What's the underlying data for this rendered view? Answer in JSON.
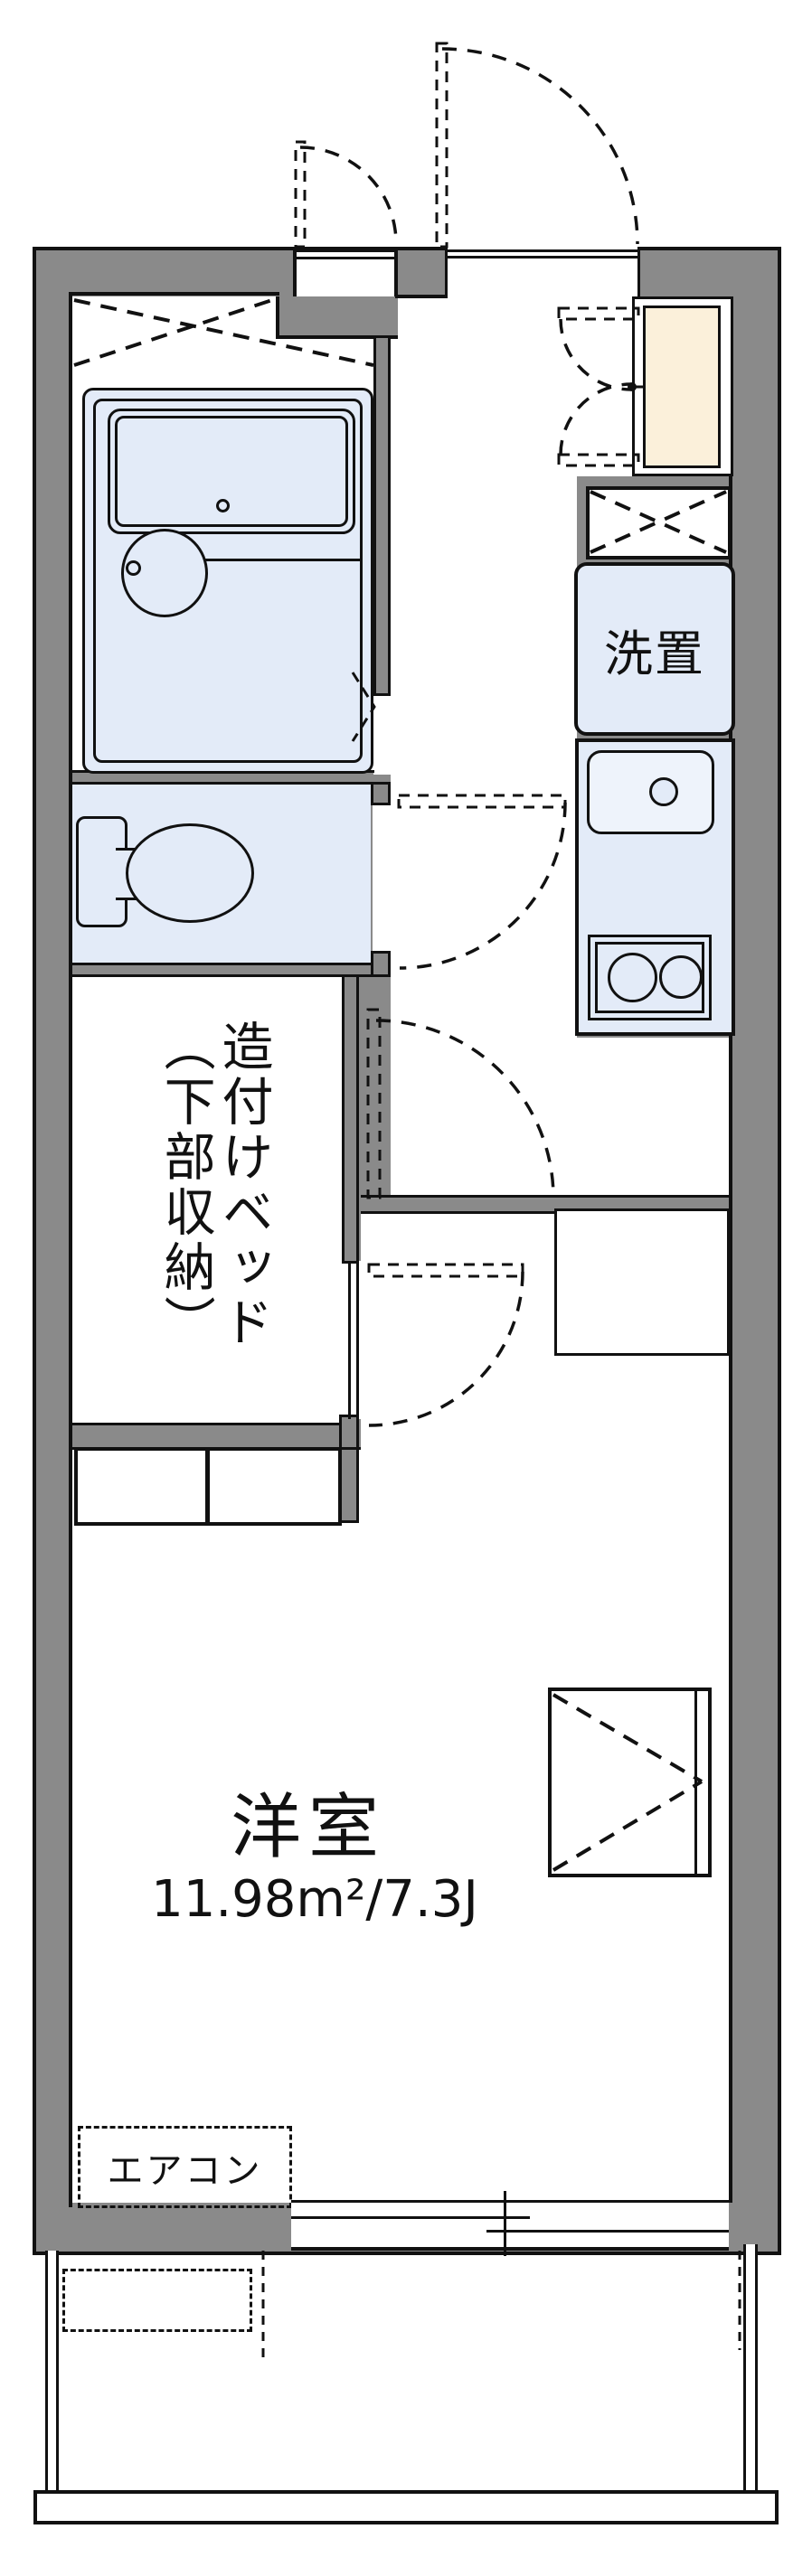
{
  "plan": {
    "type": "japanese-apartment-floor-plan",
    "labels": {
      "laundry": "洗置",
      "bed_col_right": "造付けベッド",
      "bed_col_left": "（下部収納）",
      "main_room": "洋室",
      "main_room_area": "11.98m²/7.3J",
      "aircon": "エアコン"
    },
    "colors": {
      "wall": "#8a8a8a",
      "line": "#111111",
      "blue": "#e3ebf8",
      "blue2": "#eef3fb",
      "beige": "#fbf0da",
      "bg": "#ffffff"
    }
  }
}
